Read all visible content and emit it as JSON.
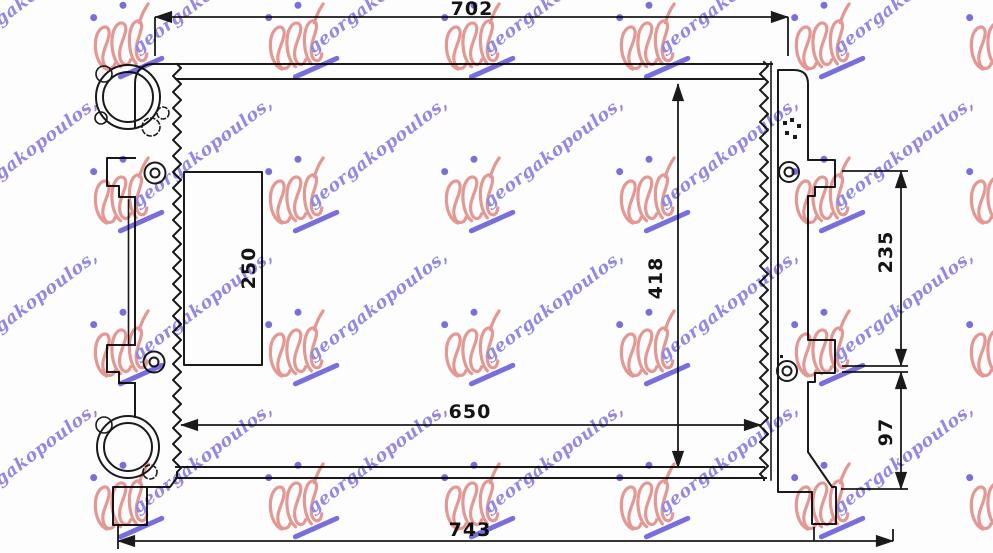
{
  "drawing": {
    "dimensions": {
      "top_width": "702",
      "bottom_width": "743",
      "core_width": "650",
      "core_height": "418",
      "bracket_span": "235",
      "lower_offset": "97",
      "inner_height": "250"
    }
  },
  "watermark": {
    "text": "georgakopoulos,",
    "script_color": "#7b6fe2",
    "stamp_color": "#e0837c",
    "accent_color": "#5b50d8"
  }
}
